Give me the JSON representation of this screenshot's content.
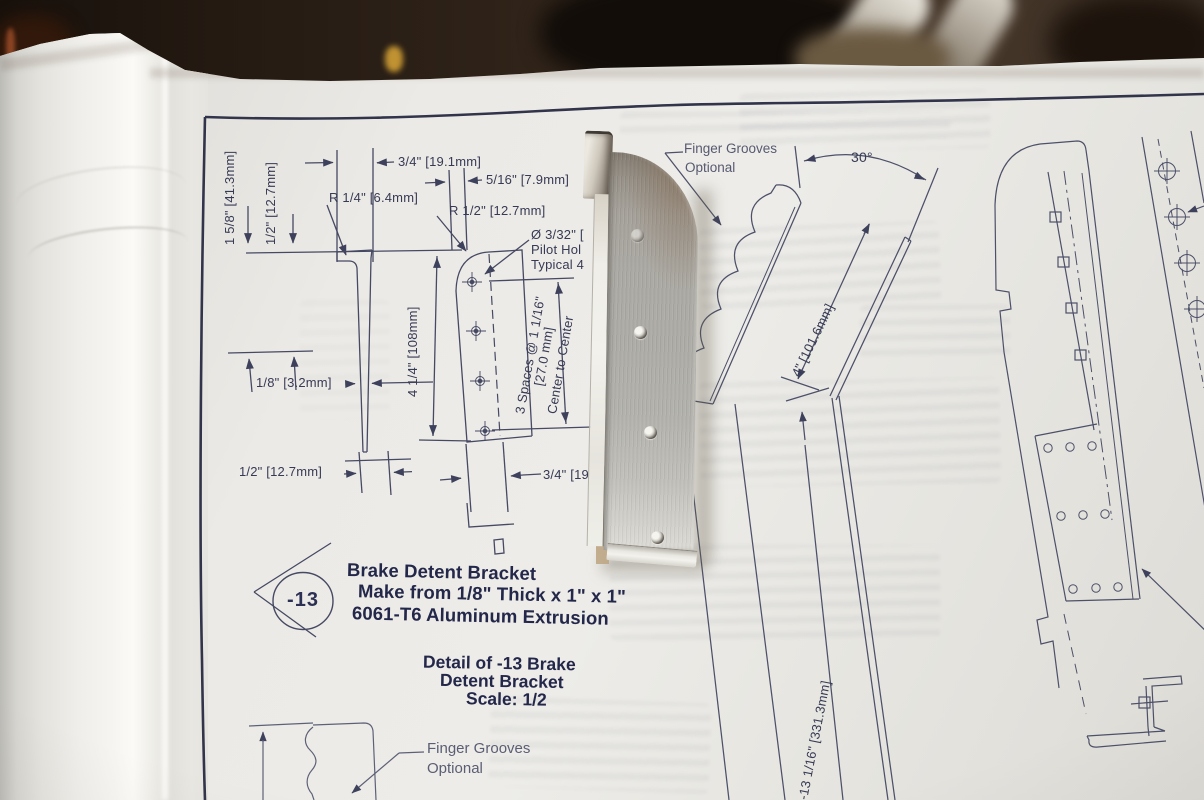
{
  "scene": {
    "paper_color": "#e9e8e3",
    "line_color": "#454963",
    "text_color": "#363a54",
    "bold_text_color": "#23274a",
    "metal_color": "#a9a7a1",
    "background_color": "#3a2b1f"
  },
  "drawing": {
    "detail_view": {
      "dims": {
        "height_1": "1 5/8\" [41.3mm]",
        "height_2": "1/2\" [12.7mm]",
        "width_top": "3/4\" [19.1mm]",
        "width_flange": "5/16\" [7.9mm]",
        "radius_1": "R 1/4\" [6.4mm]",
        "radius_2": "R 1/2\" [12.7mm]",
        "pilot_l1": "Ø 3/32\" [",
        "pilot_l2": "Pilot Hol",
        "pilot_l3": "Typical 4",
        "length": "4 1/4\" [108mm]",
        "spaces_l1": "3 Spaces @ 1 1/16\"",
        "spaces_l2": "[27.0 mm]",
        "spaces_l3": "Center to Center",
        "thickness": "1/8\" [3.2mm]",
        "width_bot1": "1/2\" [12.7mm]",
        "width_bot2": "3/4\" [19.1"
      },
      "callout": "-13",
      "title_l1": "Brake Detent Bracket",
      "title_l2": "Make from 1/8\" Thick x 1\" x 1\"",
      "title_l3": "6061-T6 Aluminum Extrusion",
      "caption_l1": "Detail of -13 Brake",
      "caption_l2": "Detent Bracket",
      "caption_l3": "Scale: 1/2",
      "finger_note_l1": "Finger Grooves",
      "finger_note_l2": "Optional"
    },
    "right_view": {
      "finger_note_l1": "Finger Grooves",
      "finger_note_l2": "Optional",
      "angle": "30°",
      "length": "4\" [101.6mm]",
      "overall": "-13 1/16\" [331.3mm]"
    }
  }
}
